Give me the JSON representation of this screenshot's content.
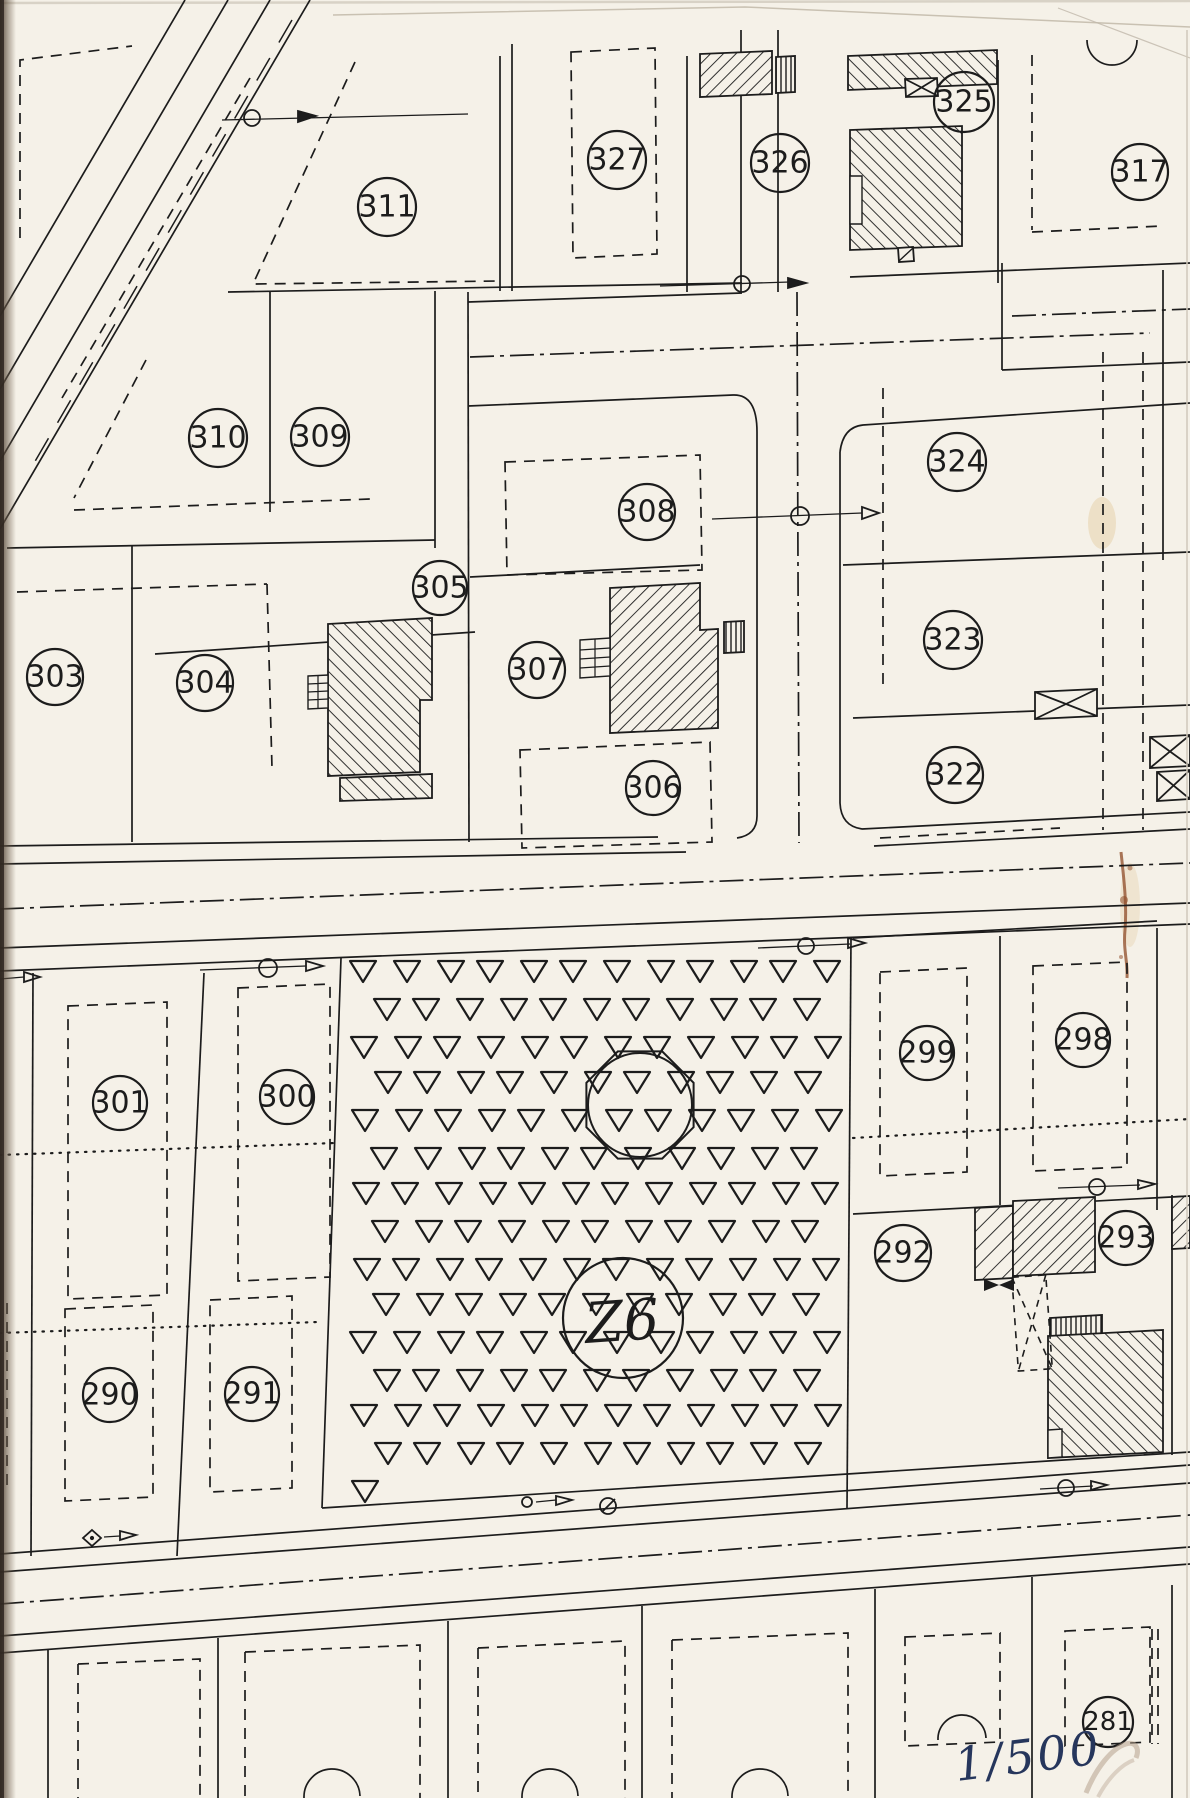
{
  "map": {
    "kind": "cadastral plan scan",
    "scale_note": {
      "text": "1/500",
      "x": 1030,
      "y": 1772,
      "rotate": -7,
      "ink": "#26365c"
    },
    "zone_label": {
      "text": "Z6",
      "x": 622,
      "y": 1322,
      "r": 60,
      "rotate": -4
    },
    "parcels": [
      {
        "number": "311",
        "x": 387,
        "y": 207,
        "r": 29
      },
      {
        "number": "327",
        "x": 617,
        "y": 160,
        "r": 29
      },
      {
        "number": "326",
        "x": 780,
        "y": 163,
        "r": 29
      },
      {
        "number": "325",
        "x": 964,
        "y": 102,
        "r": 30
      },
      {
        "number": "317",
        "x": 1140,
        "y": 172,
        "r": 28
      },
      {
        "number": "310",
        "x": 218,
        "y": 438,
        "r": 29
      },
      {
        "number": "309",
        "x": 320,
        "y": 437,
        "r": 29
      },
      {
        "number": "308",
        "x": 647,
        "y": 512,
        "r": 28
      },
      {
        "number": "324",
        "x": 957,
        "y": 462,
        "r": 29
      },
      {
        "number": "305",
        "x": 440,
        "y": 588,
        "r": 27
      },
      {
        "number": "307",
        "x": 537,
        "y": 670,
        "r": 28
      },
      {
        "number": "303",
        "x": 55,
        "y": 677,
        "r": 28
      },
      {
        "number": "304",
        "x": 205,
        "y": 683,
        "r": 28
      },
      {
        "number": "323",
        "x": 953,
        "y": 640,
        "r": 29
      },
      {
        "number": "306",
        "x": 653,
        "y": 788,
        "r": 27
      },
      {
        "number": "322",
        "x": 955,
        "y": 775,
        "r": 28
      },
      {
        "number": "301",
        "x": 120,
        "y": 1103,
        "r": 27
      },
      {
        "number": "300",
        "x": 287,
        "y": 1097,
        "r": 27
      },
      {
        "number": "299",
        "x": 927,
        "y": 1053,
        "r": 27
      },
      {
        "number": "298",
        "x": 1083,
        "y": 1040,
        "r": 27
      },
      {
        "number": "292",
        "x": 903,
        "y": 1253,
        "r": 28
      },
      {
        "number": "293",
        "x": 1126,
        "y": 1238,
        "r": 27
      },
      {
        "number": "290",
        "x": 110,
        "y": 1395,
        "r": 27
      },
      {
        "number": "291",
        "x": 252,
        "y": 1394,
        "r": 27
      }
    ],
    "partial_labels": [
      {
        "number": "281",
        "x": 1108,
        "y": 1722,
        "r": 25
      }
    ],
    "colors": {
      "paper": "#f5f1e8",
      "ink": "#1c1c1c",
      "rust_stain": "#8d4a26",
      "pencil": "#b4a18c",
      "hand_ink": "#26365c"
    }
  }
}
